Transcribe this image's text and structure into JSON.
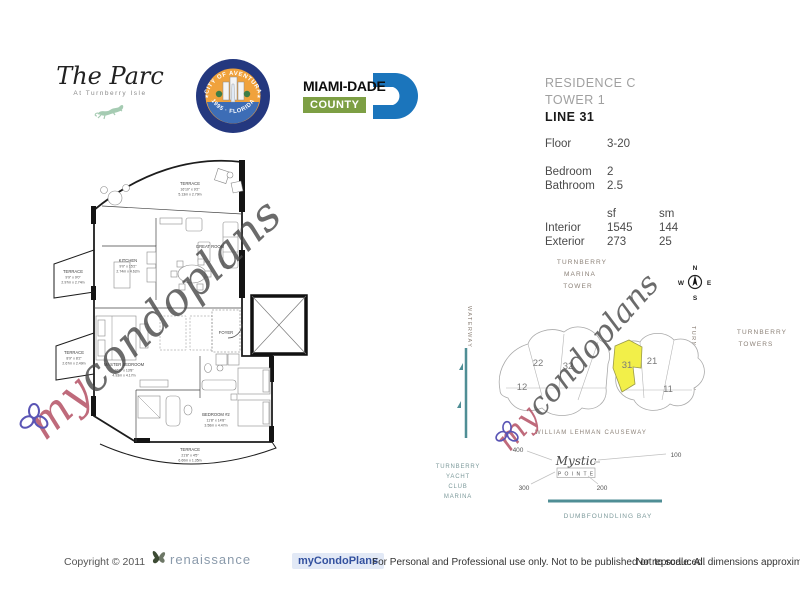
{
  "header": {
    "parc": {
      "title": "The Parc",
      "subtitle": "At Turnberry Isle"
    },
    "seal": {
      "top_text": "CITY OF AVENTURA",
      "bottom_text": "1995 · FLORIDA"
    },
    "miami_dade": {
      "name": "MIAMI-DADE",
      "county": "COUNTY"
    }
  },
  "info_panel": {
    "residence": "RESIDENCE C",
    "tower": "TOWER 1",
    "line": "LINE 31",
    "floor_label": "Floor",
    "floor_value": "3-20",
    "bedroom_label": "Bedroom",
    "bedroom_value": "2",
    "bathroom_label": "Bathroom",
    "bathroom_value": "2.5",
    "area": {
      "col_sf": "sf",
      "col_sm": "sm",
      "interior_label": "Interior",
      "interior_sf": "1545",
      "interior_sm": "144",
      "exterior_label": "Exterior",
      "exterior_sf": "273",
      "exterior_sm": "25"
    }
  },
  "floor_plan": {
    "terrace_top": [
      "TERRACE",
      "16'10\" x 9'2\"",
      "5.13m x 2.79m"
    ],
    "kitchen": [
      "KITCHEN",
      "9'0\" x 15'2\"",
      "2.74m x 4.62m"
    ],
    "terrace_ul": [
      "TERRACE",
      "9'9\" x 9'0\"",
      "2.97m x 2.74m"
    ],
    "terrace_ll": [
      "TERRACE",
      "8'9\" x 8'2\"",
      "2.67m x 2.49m"
    ],
    "master": [
      "MASTER BEDROOM",
      "16'2\" x 13'8\"",
      "4.93m x 4.17m"
    ],
    "bedroom2": [
      "BEDROOM #2",
      "11'8\" x 14'8\"",
      "3.56m x 4.47m"
    ],
    "terrace_bottom": [
      "TERRACE",
      "21'8\" x 4'5\"",
      "6.60m x 1.35m"
    ],
    "great_room": "GREAT ROOM",
    "foyer": "FOYER"
  },
  "site_map": {
    "marina_tower": [
      "TURNBERRY",
      "MARINA",
      "TOWER"
    ],
    "turnberry_towers": [
      "TURNBERRY",
      "TOWERS"
    ],
    "turnberry_way": "TURNBERRY WAY",
    "waterway": "WATERWAY",
    "causeway": "WILLIAM LEHMAN CAUSEWAY",
    "yacht_club": [
      "TURNBERRY",
      "YACHT",
      "CLUB",
      "MARINA"
    ],
    "mystic": {
      "line1": "Mystic",
      "line2": "P O I N T E"
    },
    "bay": "DUMBFOUNDLING BAY",
    "compass": {
      "n": "N",
      "s": "S",
      "e": "E",
      "w": "W"
    },
    "units": {
      "u22": "22",
      "u32": "32",
      "u12": "12",
      "u31": "31",
      "u21": "21",
      "u11": "11"
    },
    "distances": {
      "d400": "400",
      "d100": "100",
      "d300": "300",
      "d200": "200"
    }
  },
  "watermark": {
    "my": "my",
    "rest": "condoplans"
  },
  "footer": {
    "copyright": "Copyright © 2011",
    "renaissance": "renaissance",
    "mycondoplans": "myCondoPlans",
    "usage": "For Personal and Professional use only.  Not to be published or reproduced.",
    "scale_note": "Not to scale.  All dimensions approximate."
  },
  "colors": {
    "teal": "#4f8e95",
    "highlight_yellow": "#f2ef49",
    "watermark_red": "#b9556b",
    "miami_blue": "#1b75bc",
    "county_green": "#7d9f44",
    "seal_navy": "#24387f",
    "seal_orange": "#f0a23c"
  }
}
